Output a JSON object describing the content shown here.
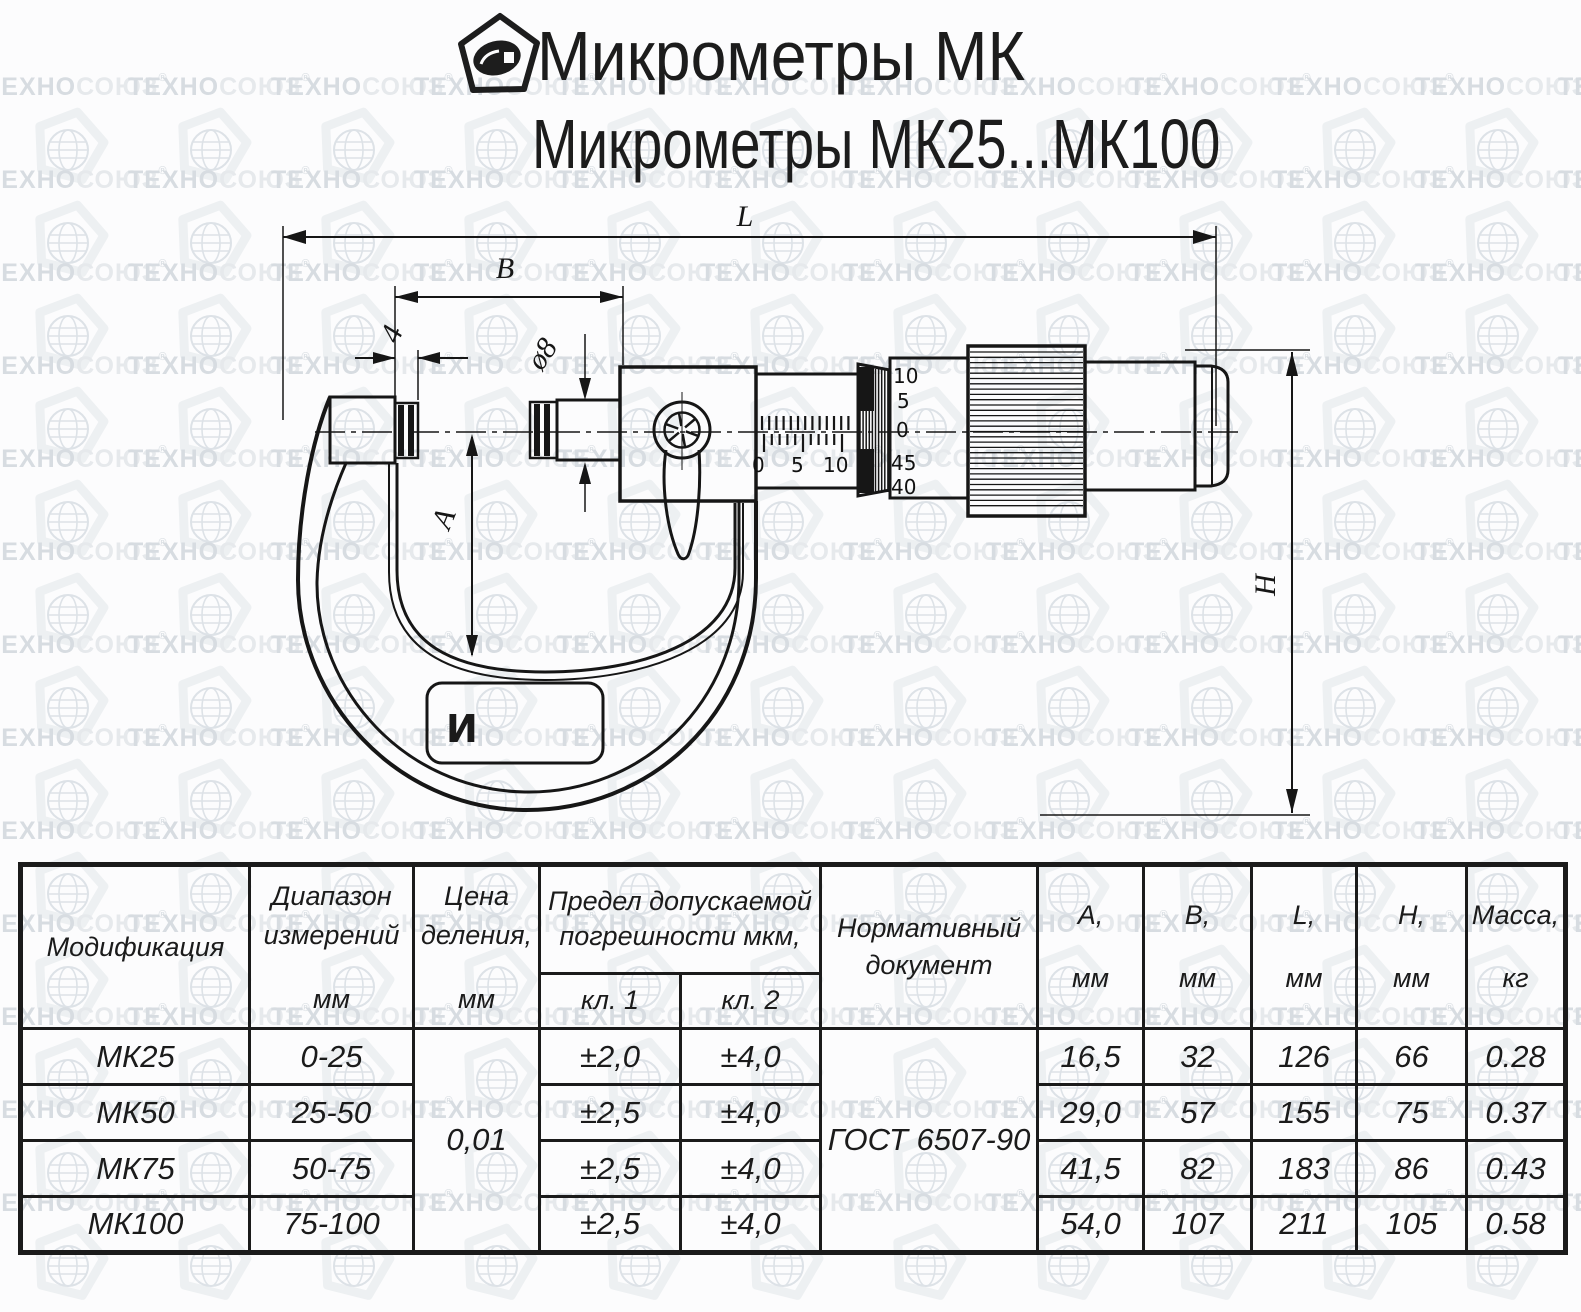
{
  "watermark": {
    "text_primary": "ТЕХНО",
    "text_secondary": "СОЮЗ",
    "reg_mark": "®",
    "rows": 13,
    "cols": 12,
    "pitch_x": 143,
    "pitch_y": 93
  },
  "header": {
    "title_line1": "Микрометры МК",
    "title_line2": "Микрометры МК25...МК100"
  },
  "drawing": {
    "labels": {
      "length": "L",
      "width_b": "B",
      "tip_width": "4",
      "spindle_diameter": "ø8",
      "throat_depth": "A",
      "height": "H"
    },
    "sleeve_scale": [
      "0",
      "5",
      "10"
    ],
    "thimble_scale": [
      "10",
      "5",
      "0",
      "45",
      "40"
    ],
    "plate_logo": "И"
  },
  "table": {
    "headers": {
      "modification": "Модификация",
      "range_l1": "Диапазон",
      "range_l2": "измерений",
      "range_unit": "мм",
      "division_l1": "Цена",
      "division_l2": "деления,",
      "division_unit": "мм",
      "error_l1": "Предел допускаемой",
      "error_l2": "погрешности мкм,",
      "class1": "кл. 1",
      "class2": "кл. 2",
      "document_l1": "Нормативный",
      "document_l2": "документ",
      "a_label": "А,",
      "b_label": "В,",
      "l_label": "L,",
      "h_label": "Н,",
      "mass_label": "Масса,",
      "unit_mm": "мм",
      "unit_kg": "кг"
    },
    "shared": {
      "division_value": "0,01",
      "document_value": "ГОСТ 6507-90"
    },
    "rows": [
      {
        "model": "МК25",
        "range": "0-25",
        "cl1": "±2,0",
        "cl2": "±4,0",
        "a": "16,5",
        "b": "32",
        "l": "126",
        "h": "66",
        "mass": "0.28"
      },
      {
        "model": "МК50",
        "range": "25-50",
        "cl1": "±2,5",
        "cl2": "±4,0",
        "a": "29,0",
        "b": "57",
        "l": "155",
        "h": "75",
        "mass": "0.37"
      },
      {
        "model": "МК75",
        "range": "50-75",
        "cl1": "±2,5",
        "cl2": "±4,0",
        "a": "41,5",
        "b": "82",
        "l": "183",
        "h": "86",
        "mass": "0.43"
      },
      {
        "model": "МК100",
        "range": "75-100",
        "cl1": "±2,5",
        "cl2": "±4,0",
        "a": "54,0",
        "b": "107",
        "l": "211",
        "h": "105",
        "mass": "0.58"
      }
    ]
  },
  "colors": {
    "ink": "#161616",
    "watermark_dark": "#d7dce1",
    "watermark_light": "#e6e9ec"
  }
}
